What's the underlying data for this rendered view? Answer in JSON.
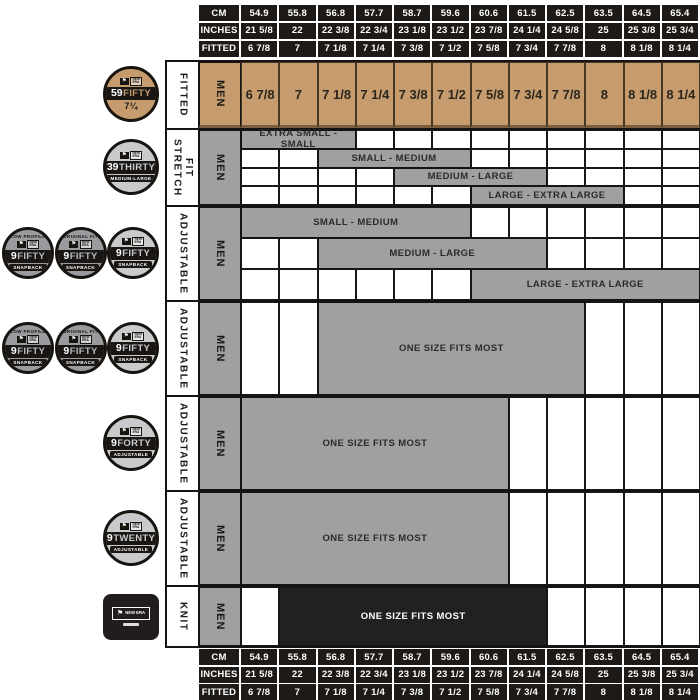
{
  "title": "New Era cap size chart",
  "colors": {
    "tan": "#C69C6E",
    "gray": "#9EA0A2",
    "ink": "#1D1A17",
    "knit_black": "#232020",
    "bar_text": "#2B2B2B",
    "white": "#FFFFFF"
  },
  "columns": {
    "cm": [
      "54.9",
      "55.8",
      "56.8",
      "57.7",
      "58.7",
      "59.6",
      "60.6",
      "61.5",
      "62.5",
      "63.5",
      "64.5",
      "65.4"
    ],
    "inches": [
      "21 5/8",
      "22",
      "22 3/8",
      "22 3/4",
      "23 1/8",
      "23 1/2",
      "23 7/8",
      "24 1/4",
      "24 5/8",
      "25",
      "25 3/8",
      "25 3/4"
    ],
    "fitted": [
      "6 7/8",
      "7",
      "7 1/8",
      "7 1/4",
      "7 3/8",
      "7 1/2",
      "7 5/8",
      "7 3/4",
      "7 7/8",
      "8",
      "8 1/8",
      "8 1/4"
    ]
  },
  "scale_rows": [
    {
      "key": "cm",
      "label": "CM"
    },
    {
      "key": "inches",
      "label": "INCHES"
    },
    {
      "key": "fitted",
      "label": "FITTED"
    }
  ],
  "body_rows": [
    {
      "id": "fitted-59fifty",
      "category": "FITTED",
      "gender": "MEN",
      "kind": "cells",
      "row_height": 68,
      "cells": [
        "6 7/8",
        "7",
        "7 1/8",
        "7 1/4",
        "7 3/8",
        "7 1/2",
        "7 5/8",
        "7 3/4",
        "7 7/8",
        "8",
        "8 1/8",
        "8 1/4"
      ],
      "badges": [
        {
          "style": "gold",
          "top": "",
          "num": "59",
          "name": "FIFTY",
          "sub": "7¼",
          "sub_style": "plain"
        }
      ]
    },
    {
      "id": "stretch-39thirty",
      "category": "STRETCH FIT",
      "gender": "MEN",
      "kind": "bars",
      "row_height": 77,
      "bars": [
        {
          "label": "EXTRA SMALL - SMALL",
          "start": 1,
          "end": 3
        },
        {
          "label": "SMALL - MEDIUM",
          "start": 3,
          "end": 6
        },
        {
          "label": "MEDIUM - LARGE",
          "start": 5,
          "end": 8
        },
        {
          "label": "LARGE - EXTRA LARGE",
          "start": 7,
          "end": 10
        }
      ],
      "badges": [
        {
          "style": "silver",
          "top": "",
          "num": "39",
          "name": "THIRTY",
          "sub": "MEDIUM-LARGE",
          "sub_style": "banner"
        }
      ]
    },
    {
      "id": "adjustable-9fifty-snapback",
      "category": "ADJUSTABLE",
      "gender": "MEN",
      "kind": "bars",
      "row_height": 95,
      "bars": [
        {
          "label": "SMALL - MEDIUM",
          "start": 1,
          "end": 6
        },
        {
          "label": "MEDIUM - LARGE",
          "start": 3,
          "end": 8
        },
        {
          "label": "LARGE - EXTRA LARGE",
          "start": 7,
          "end": 12
        }
      ],
      "badges": [
        {
          "style": "dark",
          "top": "LOW PROFILE",
          "num": "9",
          "name": "FIFTY",
          "sub": "SNAPBACK",
          "sub_style": "banner"
        },
        {
          "style": "dark",
          "top": "ORIGINAL FIT",
          "num": "9",
          "name": "FIFTY",
          "sub": "SNAPBACK",
          "sub_style": "banner"
        },
        {
          "style": "silver",
          "top": "",
          "num": "9",
          "name": "FIFTY",
          "sub": "SNAPBACK",
          "sub_style": "banner"
        }
      ]
    },
    {
      "id": "adjustable-9fifty-osfm",
      "category": "ADJUSTABLE",
      "gender": "MEN",
      "kind": "bars",
      "row_height": 95,
      "bars": [
        {
          "label": "ONE SIZE FITS MOST",
          "start": 3,
          "end": 9
        }
      ],
      "badges": [
        {
          "style": "dark",
          "top": "LOW PROFILE",
          "num": "9",
          "name": "FIFTY",
          "sub": "SNAPBACK",
          "sub_style": "banner"
        },
        {
          "style": "dark",
          "top": "ORIGINAL FIT",
          "num": "9",
          "name": "FIFTY",
          "sub": "SNAPBACK",
          "sub_style": "banner"
        },
        {
          "style": "silver",
          "top": "",
          "num": "9",
          "name": "FIFTY",
          "sub": "SNAPBACK",
          "sub_style": "banner"
        }
      ]
    },
    {
      "id": "adjustable-9forty",
      "category": "ADJUSTABLE",
      "gender": "MEN",
      "kind": "bars",
      "row_height": 95,
      "bars": [
        {
          "label": "ONE SIZE FITS MOST",
          "start": 1,
          "end": 7
        }
      ],
      "badges": [
        {
          "style": "silver",
          "top": "",
          "num": "9",
          "name": "FORTY",
          "sub": "ADJUSTABLE",
          "sub_style": "banner"
        }
      ]
    },
    {
      "id": "adjustable-9twenty",
      "category": "ADJUSTABLE",
      "gender": "MEN",
      "kind": "bars",
      "row_height": 95,
      "bars": [
        {
          "label": "ONE SIZE FITS MOST",
          "start": 1,
          "end": 7
        }
      ],
      "badges": [
        {
          "style": "silver",
          "top": "",
          "num": "9",
          "name": "TWENTY",
          "sub": "ADJUSTABLE",
          "sub_style": "banner"
        }
      ]
    },
    {
      "id": "knit",
      "category": "KNIT",
      "gender": "MEN",
      "kind": "bars",
      "row_height": 63,
      "bars": [
        {
          "label": "ONE SIZE FITS MOST",
          "start": 2,
          "end": 8,
          "theme": "black"
        }
      ],
      "badges": [
        {
          "style": "patch",
          "flag": "⚑",
          "brand": "NEW ERA"
        }
      ]
    }
  ],
  "chart_data": {
    "type": "table",
    "title": "New Era cap size chart (MEN)",
    "head_circumference_cm": [
      54.9,
      55.8,
      56.8,
      57.7,
      58.7,
      59.6,
      60.6,
      61.5,
      62.5,
      63.5,
      64.5,
      65.4
    ],
    "head_circumference_inches": [
      "21 5/8",
      "22",
      "22 3/8",
      "22 3/4",
      "23 1/8",
      "23 1/2",
      "23 7/8",
      "24 1/4",
      "24 5/8",
      "25",
      "25 3/8",
      "25 3/4"
    ],
    "fitted_sizes": [
      "6 7/8",
      "7",
      "7 1/8",
      "7 1/4",
      "7 3/8",
      "7 1/2",
      "7 5/8",
      "7 3/4",
      "7 7/8",
      "8",
      "8 1/8",
      "8 1/4"
    ],
    "products": [
      {
        "name": "59FIFTY",
        "fit": "FITTED",
        "ranges": [
          {
            "label": "FITTED SIZES",
            "fitted_span": [
              "6 7/8",
              "8 1/4"
            ]
          }
        ]
      },
      {
        "name": "39THIRTY",
        "fit": "STRETCH FIT",
        "ranges": [
          {
            "label": "EXTRA SMALL - SMALL",
            "fitted_span": [
              "6 7/8",
              "7 1/8"
            ]
          },
          {
            "label": "SMALL - MEDIUM",
            "fitted_span": [
              "7 1/8",
              "7 1/2"
            ]
          },
          {
            "label": "MEDIUM - LARGE",
            "fitted_span": [
              "7 3/8",
              "7 3/4"
            ]
          },
          {
            "label": "LARGE - EXTRA LARGE",
            "fitted_span": [
              "7 5/8",
              "8"
            ]
          }
        ]
      },
      {
        "name": "9FIFTY SNAPBACK",
        "fit": "ADJUSTABLE",
        "ranges": [
          {
            "label": "SMALL - MEDIUM",
            "fitted_span": [
              "6 7/8",
              "7 1/2"
            ]
          },
          {
            "label": "MEDIUM - LARGE",
            "fitted_span": [
              "7 1/8",
              "7 3/4"
            ]
          },
          {
            "label": "LARGE - EXTRA LARGE",
            "fitted_span": [
              "7 5/8",
              "8 1/4"
            ]
          }
        ]
      },
      {
        "name": "9FIFTY",
        "fit": "ADJUSTABLE",
        "ranges": [
          {
            "label": "ONE SIZE FITS MOST",
            "fitted_span": [
              "7 1/8",
              "7 7/8"
            ]
          }
        ]
      },
      {
        "name": "9FORTY",
        "fit": "ADJUSTABLE",
        "ranges": [
          {
            "label": "ONE SIZE FITS MOST",
            "fitted_span": [
              "6 7/8",
              "7 5/8"
            ]
          }
        ]
      },
      {
        "name": "9TWENTY",
        "fit": "ADJUSTABLE",
        "ranges": [
          {
            "label": "ONE SIZE FITS MOST",
            "fitted_span": [
              "6 7/8",
              "7 5/8"
            ]
          }
        ]
      },
      {
        "name": "KNIT",
        "fit": "KNIT",
        "ranges": [
          {
            "label": "ONE SIZE FITS MOST",
            "fitted_span": [
              "7",
              "7 3/4"
            ]
          }
        ]
      }
    ]
  }
}
